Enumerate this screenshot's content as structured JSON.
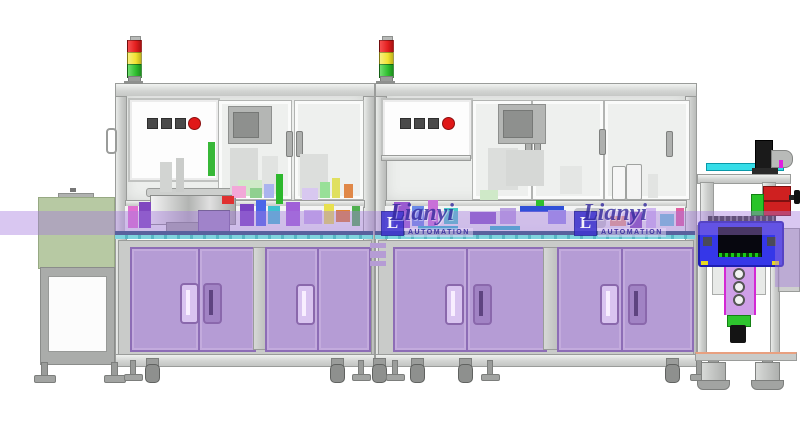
{
  "scene": {
    "description": "Side-view CAD rendering of a two-module automated assembly machine line with signal towers, feeder bowl, purple tooling cabinets and a blue out-feed inspection station",
    "background": "#ffffff"
  },
  "watermark": {
    "brand": "Lianyi",
    "subtitle": "AUTOMATION",
    "logo_letter": "L",
    "text_color": "#352b9e",
    "band_color": "rgba(165,122,222,0.42)"
  },
  "palette": {
    "frame": "#d5d7d5",
    "frame_line": "#999b99",
    "glass": "#edefed",
    "cabinet_purple": "#b59cd5",
    "cabinet_border": "#8d6db6",
    "table_navy": "#24506e",
    "table_cyan": "#7fd4de",
    "station_blue": "#3537e8",
    "left_station_green": "#b7c9a3",
    "signal_red": "#e31e1e",
    "signal_yellow": "#f2e232",
    "signal_green": "#2fbe2f",
    "button_red": "#e01818",
    "conveyor_green_line": "#00dd00"
  },
  "signal_tower_colors": [
    "#e31e1e",
    "#f2e232",
    "#2fbe2f"
  ],
  "decor": {
    "format": "[x, y, w, h, color, radius?, border?]",
    "parts": [
      [
        230,
        148,
        28,
        46,
        "#d9dbd9"
      ],
      [
        262,
        156,
        16,
        38,
        "#e1e3e1"
      ],
      [
        300,
        154,
        28,
        44,
        "#dcdedc"
      ],
      [
        238,
        180,
        24,
        16,
        "#cfe9c8"
      ],
      [
        208,
        142,
        7,
        34,
        "#38b838"
      ],
      [
        276,
        174,
        7,
        30,
        "#2db82d"
      ],
      [
        160,
        162,
        12,
        30,
        "#d2d4d2"
      ],
      [
        176,
        158,
        8,
        34,
        "#caccca"
      ],
      [
        232,
        186,
        14,
        12,
        "#f2a8d8"
      ],
      [
        250,
        188,
        12,
        10,
        "#8fd08f"
      ],
      [
        264,
        184,
        10,
        14,
        "#aab4ee"
      ],
      [
        302,
        188,
        16,
        12,
        "#d8c8f0"
      ],
      [
        320,
        182,
        10,
        16,
        "#98e098"
      ],
      [
        332,
        178,
        8,
        20,
        "#e0e060"
      ],
      [
        344,
        184,
        9,
        14,
        "#e08848"
      ],
      [
        128,
        206,
        10,
        22,
        "#e070d0"
      ],
      [
        139,
        202,
        12,
        26,
        "#8048c0"
      ],
      [
        222,
        196,
        12,
        8,
        "#e03030"
      ],
      [
        240,
        204,
        14,
        22,
        "#7a42c2"
      ],
      [
        256,
        200,
        10,
        26,
        "#4a66e8"
      ],
      [
        268,
        206,
        12,
        18,
        "#40c0d0"
      ],
      [
        286,
        202,
        14,
        24,
        "#a060d8"
      ],
      [
        304,
        210,
        18,
        14,
        "#c8b0ea"
      ],
      [
        324,
        204,
        10,
        20,
        "#e8e050"
      ],
      [
        336,
        210,
        14,
        12,
        "#e08030"
      ],
      [
        352,
        206,
        8,
        20,
        "#50b050"
      ],
      [
        488,
        148,
        30,
        42,
        "#dcdedc"
      ],
      [
        506,
        150,
        38,
        36,
        "#d6d8d6"
      ],
      [
        560,
        166,
        22,
        28,
        "#e4e6e4"
      ],
      [
        612,
        166,
        12,
        32,
        "#f6f6f6",
        2,
        "#a0a2a0"
      ],
      [
        626,
        164,
        14,
        34,
        "#f3f3f3",
        2,
        "#a0a2a0"
      ],
      [
        648,
        174,
        10,
        24,
        "#e2e4e2"
      ],
      [
        480,
        190,
        18,
        10,
        "#cfe9c8"
      ],
      [
        394,
        202,
        16,
        26,
        "#9a5ad0"
      ],
      [
        412,
        206,
        12,
        20,
        "#6a8ae8"
      ],
      [
        428,
        200,
        10,
        26,
        "#c870d8"
      ],
      [
        444,
        208,
        14,
        16,
        "#48c8c8"
      ],
      [
        470,
        212,
        26,
        12,
        "#8858c8"
      ],
      [
        500,
        208,
        16,
        16,
        "#b8a0e0"
      ],
      [
        520,
        206,
        44,
        6,
        "#3050d8"
      ],
      [
        536,
        200,
        8,
        6,
        "#30c030"
      ],
      [
        548,
        210,
        18,
        14,
        "#9890e8"
      ],
      [
        574,
        208,
        32,
        20,
        "#c6c8ca",
        4
      ],
      [
        610,
        216,
        16,
        10,
        "#e8a080"
      ],
      [
        630,
        212,
        12,
        16,
        "#8048b8"
      ],
      [
        646,
        208,
        10,
        20,
        "#d0b8f0"
      ],
      [
        660,
        214,
        14,
        12,
        "#70c8d8"
      ],
      [
        676,
        208,
        8,
        18,
        "#e060a0"
      ],
      [
        418,
        226,
        40,
        4,
        "#28b8c8"
      ],
      [
        490,
        226,
        30,
        4,
        "#28b8c8"
      ],
      [
        370,
        243,
        16,
        5,
        "#b59cd5"
      ],
      [
        370,
        251,
        16,
        7,
        "#b59cd5"
      ],
      [
        370,
        261,
        16,
        5,
        "#b59cd5"
      ]
    ]
  },
  "feet": {
    "items": [
      {
        "type": "disc",
        "x": 34
      },
      {
        "type": "disc",
        "x": 104
      },
      {
        "type": "foot",
        "x": 124
      },
      {
        "type": "caster",
        "x": 145
      },
      {
        "type": "caster",
        "x": 330
      },
      {
        "type": "foot",
        "x": 352
      },
      {
        "type": "caster",
        "x": 372
      },
      {
        "type": "foot",
        "x": 386
      },
      {
        "type": "caster",
        "x": 410
      },
      {
        "type": "caster",
        "x": 458
      },
      {
        "type": "foot",
        "x": 481
      },
      {
        "type": "caster",
        "x": 665
      },
      {
        "type": "foot",
        "x": 690
      },
      {
        "type": "big",
        "x": 700
      },
      {
        "type": "big",
        "x": 754
      }
    ]
  }
}
